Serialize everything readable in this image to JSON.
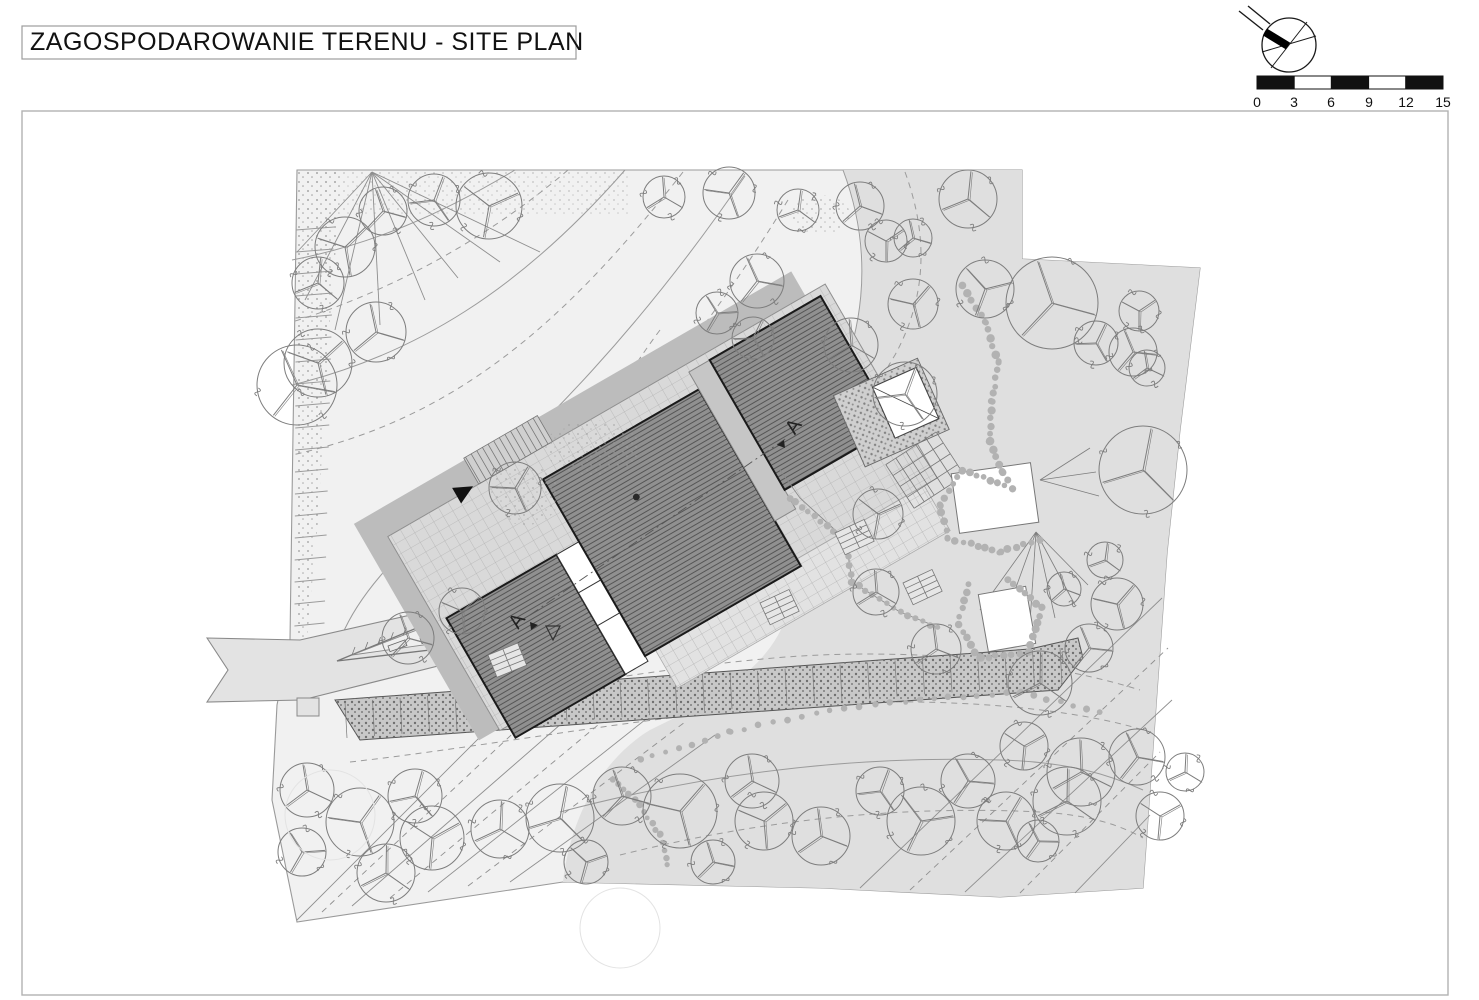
{
  "title": {
    "text": "ZAGOSPODAROWANIE TERENU - SITE PLAN"
  },
  "scale_bar": {
    "labels": [
      "0",
      "3",
      "6",
      "9",
      "12",
      "15"
    ],
    "units_shown": "meters (implied)",
    "segment_colors": [
      "#111111",
      "#ffffff",
      "#111111",
      "#ffffff",
      "#111111"
    ]
  },
  "north_arrow": {
    "icon": "compass-north-arrow"
  },
  "section_markers": {
    "label_top": "A",
    "label_bottom": "A"
  },
  "colors": {
    "page_background": "#ffffff",
    "frame_border": "#b2b2b2",
    "site_light": "#f1f1f1",
    "site_dark": "#dfdfdf",
    "roof_fill": "#8f8f8f",
    "roof_hatch": "#4e4e4e",
    "roof_outline": "#1a1a1a",
    "deck_fill": "#d9d9d9",
    "shadow": "#bcbcbc",
    "contour_line": "#9b9b9b",
    "tree_stroke": "#7d7d7d",
    "retaining_wall": "#c8c8c8",
    "stone_path": "#b2b2b2"
  }
}
